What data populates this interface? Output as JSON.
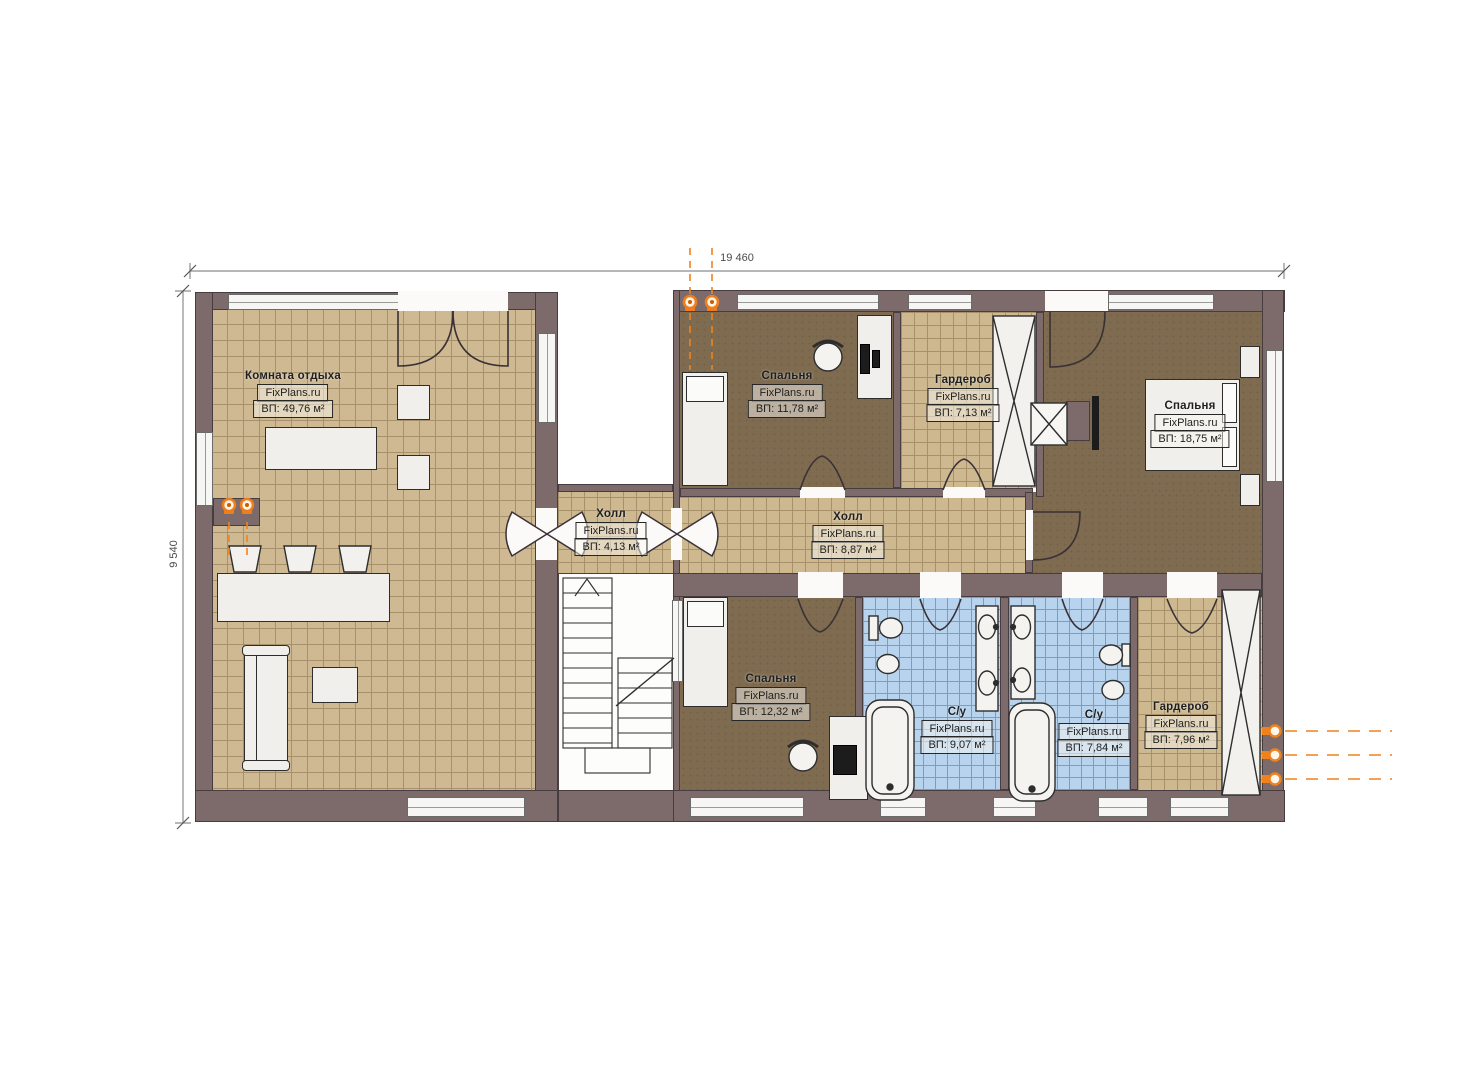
{
  "branding": {
    "watermark": "FixPlans.ru"
  },
  "dimensions": {
    "width_label": "19 460",
    "height_label": "9 540"
  },
  "rooms": {
    "rest": {
      "name": "Комната отдыха",
      "area": "ВП: 49,76 м²"
    },
    "bedroom1": {
      "name": "Спальня",
      "area": "ВП: 11,78 м²"
    },
    "wardrobe1": {
      "name": "Гардероб",
      "area": "ВП: 7,13 м²"
    },
    "bedroom2": {
      "name": "Спальня",
      "area": "ВП: 18,75 м²"
    },
    "hall1": {
      "name": "Холл",
      "area": "ВП: 4,13 м²"
    },
    "hall2": {
      "name": "Холл",
      "area": "ВП: 8,87 м²"
    },
    "bedroom3": {
      "name": "Спальня",
      "area": "ВП: 12,32 м²"
    },
    "bath1": {
      "name": "С/у",
      "area": "ВП: 9,07 м²"
    },
    "bath2": {
      "name": "С/у",
      "area": "ВП: 7,84 м²"
    },
    "wardrobe2": {
      "name": "Гардероб",
      "area": "ВП: 7,96 м²"
    }
  },
  "colors": {
    "wall": "#7d6b6b",
    "floor_tile": "#cfb992",
    "floor_wood": "#7f6b50",
    "floor_bath": "#b7d3ee",
    "accent_orange": "#f0821e"
  },
  "icons": [
    "radiator-marker",
    "pipe-riser-marker"
  ]
}
